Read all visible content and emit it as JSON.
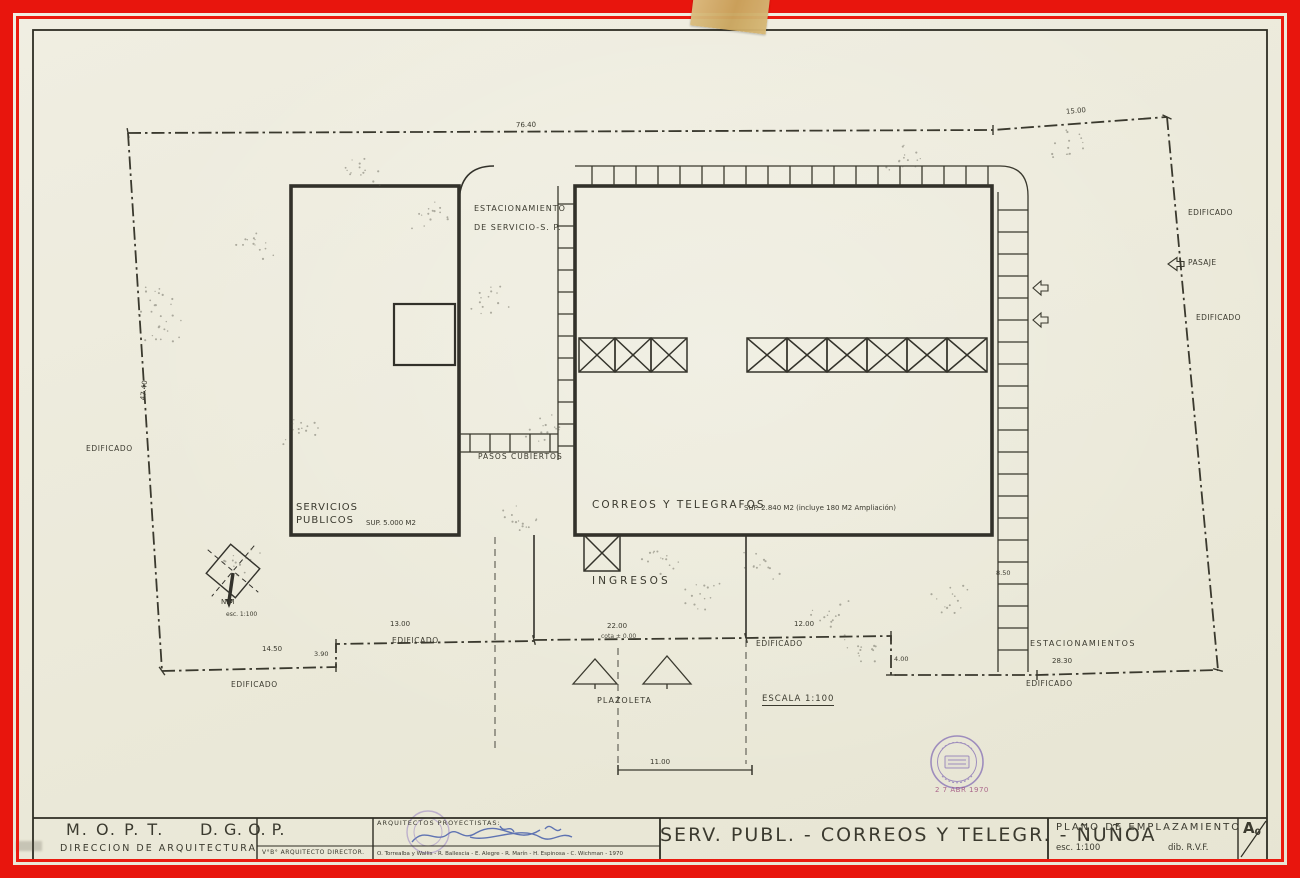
{
  "plan_labels": {
    "estacionamiento_1": "ESTACIONAMIENTO",
    "estacionamiento_2": "DE SERVICIO-S. P.",
    "servicios_1": "SERVICIOS",
    "servicios_2": "PUBLICOS",
    "servicios_sup": "SUP. 5.000 M2",
    "correos": "CORREOS Y TELEGRAFOS",
    "correos_sup": "SUP. 2.840 M2 (incluye 180 M2 Ampliación)",
    "pasos_cubiertos": "PASOS CUBIERTOS",
    "ingresos": "INGRESOS",
    "plazoleta": "PLAZOLETA",
    "escala": "ESCALA 1:100",
    "estacionamientos": "ESTACIONAMIENTOS",
    "edificado": "EDIFICADO",
    "pasaje": "PASAJE",
    "cota": "cota ± 0.00",
    "north_label": "N.M",
    "north_scale": "esc. 1:100"
  },
  "dimensions": {
    "d7640": "76.40",
    "d1500": "15.00",
    "d4740": "47.40",
    "d1450": "14.50",
    "d390": "3.90",
    "d1300": "13.00",
    "d2200": "22.00",
    "d1200": "12.00",
    "d400": "4.00",
    "d2830": "28.30",
    "d850": "8.50",
    "d1100": "11.00"
  },
  "stamp": {
    "date": "2 7 ABR 1970"
  },
  "titleblock": {
    "org_1": "M. O. P. T.",
    "org_2": "D. G. O. P.",
    "org_sub": "DIRECCION DE ARQUITECTURA",
    "vobo": "V°B° ARQUITECTO DIRECTOR.",
    "proyectistas_label": "ARQUITECTOS PROYECTISTAS:",
    "proyectistas_names": "O. Torrealba y Wallis - R. Ballescia - E. Alegre - R. Marín - H. Espinosa - C. Wichman - 1970",
    "project_title": "SERV. PUBL. - CORREOS Y TELEGR. - ÑUÑOA",
    "sheet_title": "PLANO DE EMPLAZAMIENTO",
    "scale": "esc. 1:100",
    "drawn_by": "dib. R.V.F.",
    "format_letter": "A",
    "format_sub": "0"
  }
}
